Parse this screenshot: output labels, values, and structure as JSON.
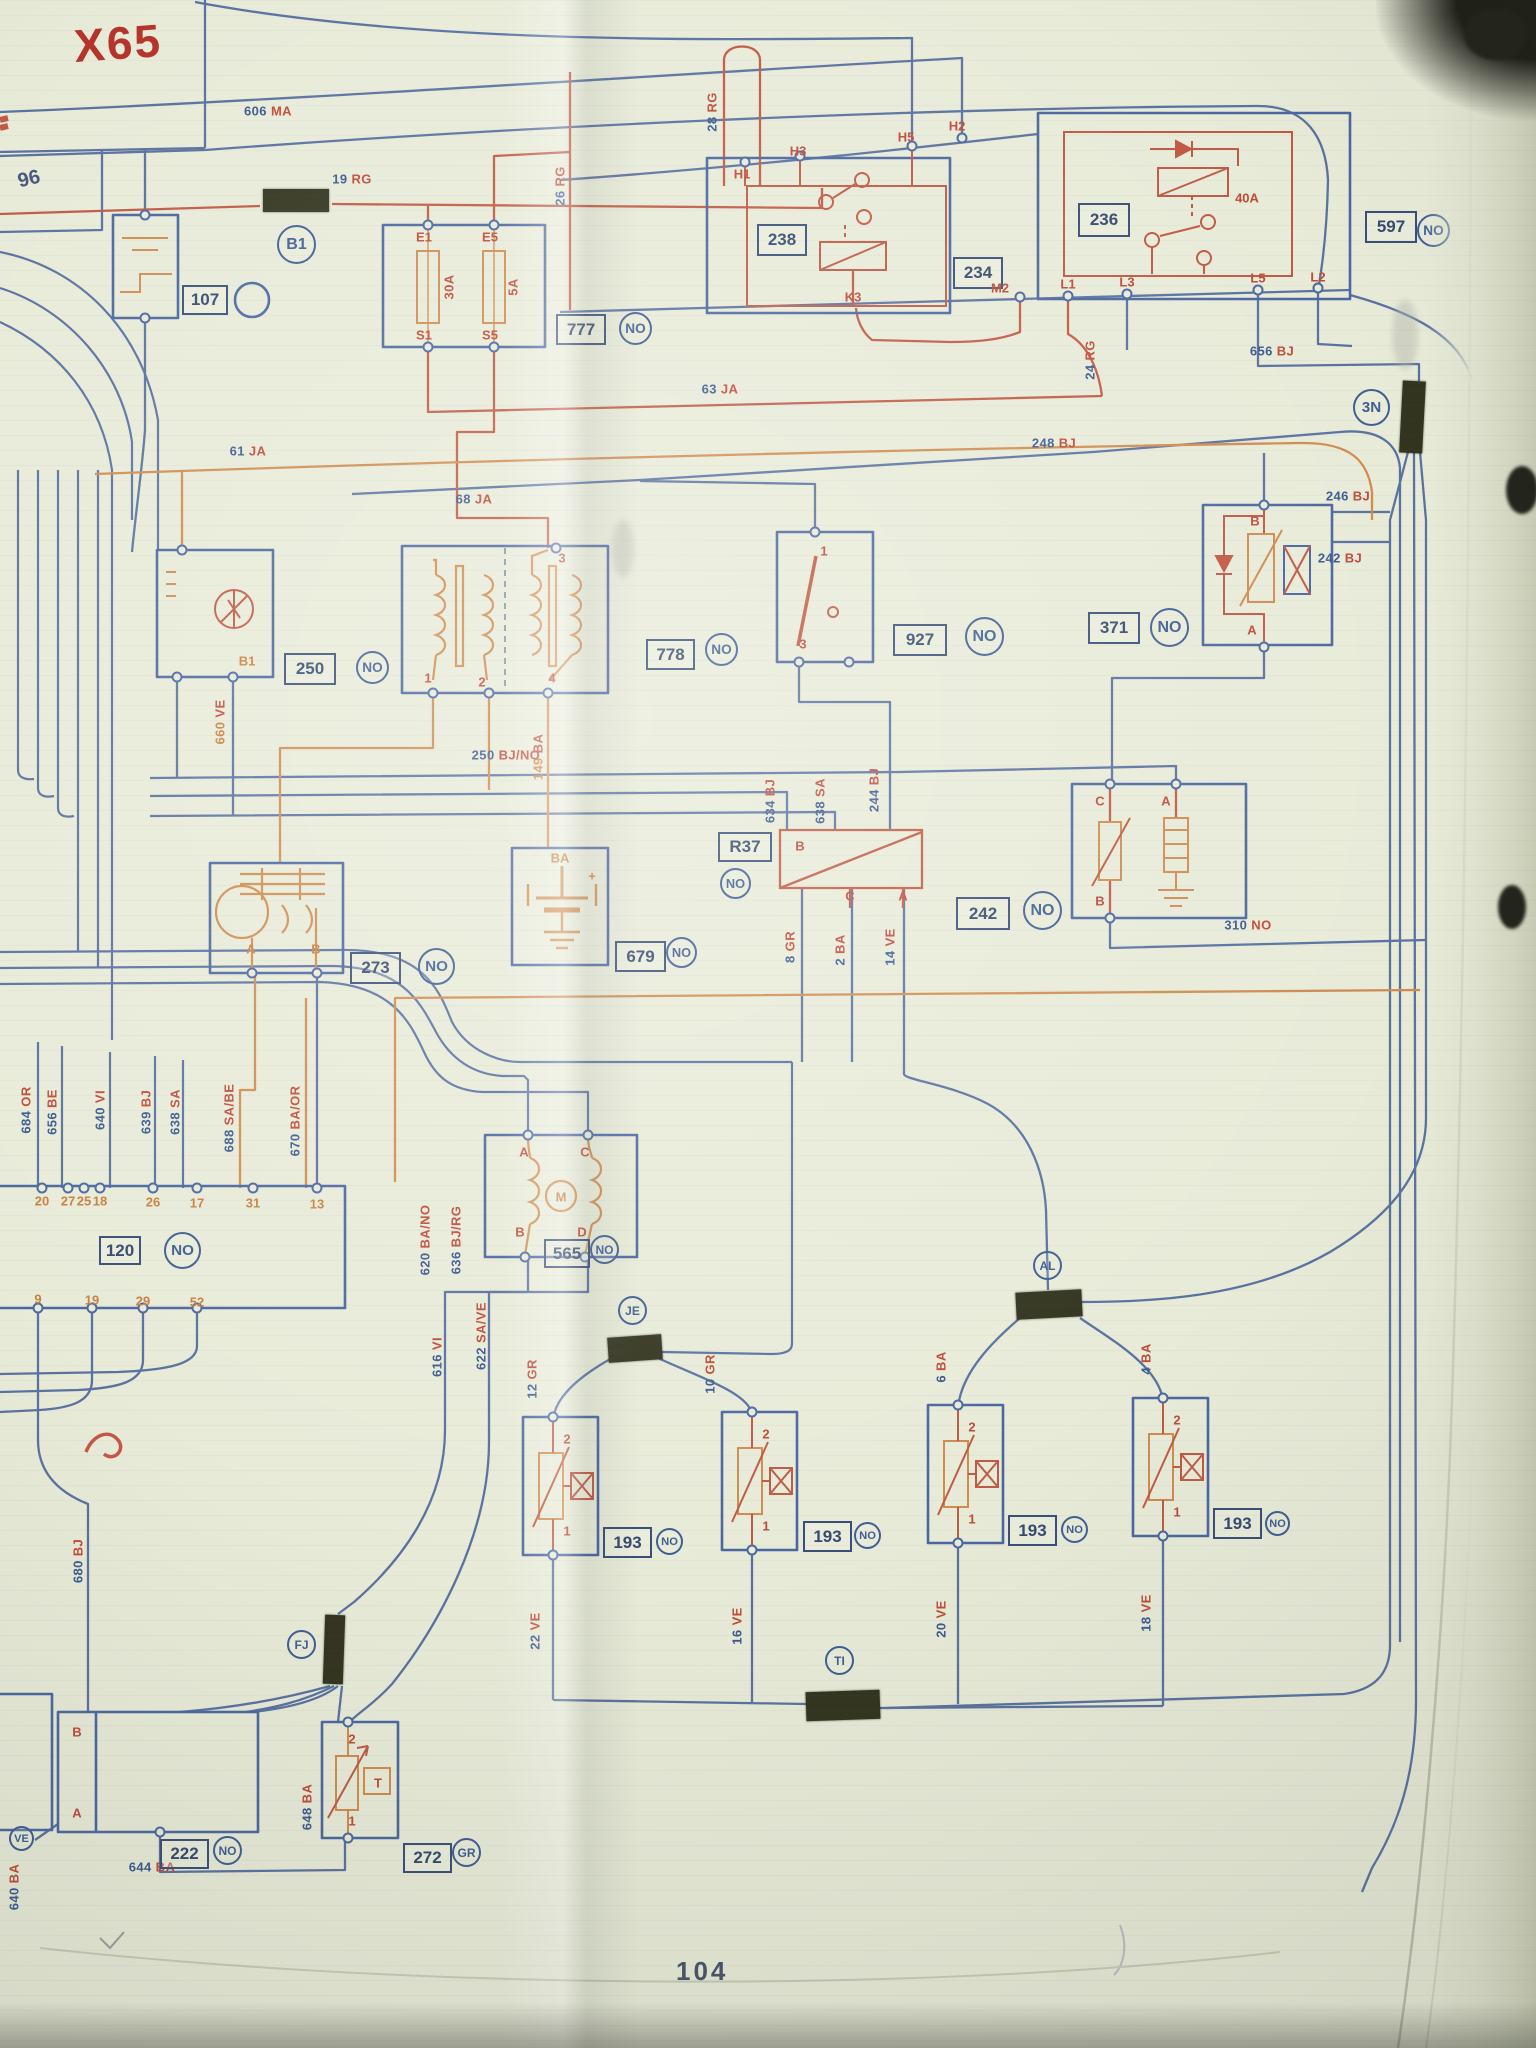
{
  "page": {
    "model_code": "X65",
    "corner_ref": "96",
    "page_number": "104"
  },
  "palette": {
    "num_blue": "#3b5a8f",
    "code_red": "#c04a38",
    "orange": "#c87f3e",
    "tag_ink": "#36496f",
    "wire_blue": "#5a72a0",
    "wire_red": "#c05a44",
    "wire_orange": "#cf8c50",
    "paper": "#e8ebd8"
  },
  "component_tags": [
    {
      "label": "238",
      "x": 757,
      "y": 224,
      "w": 46,
      "h": 28
    },
    {
      "label": "236",
      "x": 1078,
      "y": 203,
      "w": 48,
      "h": 30
    },
    {
      "label": "234",
      "x": 953,
      "y": 257,
      "w": 46,
      "h": 28
    },
    {
      "label": "777",
      "x": 556,
      "y": 314,
      "w": 46,
      "h": 27
    },
    {
      "label": "597",
      "x": 1365,
      "y": 211,
      "w": 48,
      "h": 28
    },
    {
      "label": "107",
      "x": 182,
      "y": 285,
      "w": 42,
      "h": 26
    },
    {
      "label": "250",
      "x": 284,
      "y": 653,
      "w": 48,
      "h": 28
    },
    {
      "label": "778",
      "x": 646,
      "y": 639,
      "w": 45,
      "h": 27
    },
    {
      "label": "927",
      "x": 893,
      "y": 624,
      "w": 50,
      "h": 28
    },
    {
      "label": "371",
      "x": 1088,
      "y": 612,
      "w": 48,
      "h": 28
    },
    {
      "label": "242",
      "x": 956,
      "y": 897,
      "w": 50,
      "h": 29
    },
    {
      "label": "273",
      "x": 350,
      "y": 952,
      "w": 47,
      "h": 28
    },
    {
      "label": "679",
      "x": 615,
      "y": 941,
      "w": 47,
      "h": 27
    },
    {
      "label": "565",
      "x": 544,
      "y": 1239,
      "w": 42,
      "h": 25
    },
    {
      "label": "120",
      "x": 99,
      "y": 1236,
      "w": 38,
      "h": 25
    },
    {
      "label": "R37",
      "x": 718,
      "y": 832,
      "w": 50,
      "h": 26
    },
    {
      "label": "222",
      "x": 160,
      "y": 1839,
      "w": 45,
      "h": 26
    },
    {
      "label": "272",
      "x": 403,
      "y": 1843,
      "w": 45,
      "h": 26
    },
    {
      "label": "193",
      "x": 603,
      "y": 1527,
      "w": 45,
      "h": 27
    },
    {
      "label": "193",
      "x": 803,
      "y": 1521,
      "w": 45,
      "h": 27
    },
    {
      "label": "193",
      "x": 1008,
      "y": 1515,
      "w": 45,
      "h": 27
    },
    {
      "label": "193",
      "x": 1213,
      "y": 1508,
      "w": 45,
      "h": 27
    }
  ],
  "circle_tags": [
    {
      "label": "NO",
      "x": 636,
      "y": 329,
      "r": 17
    },
    {
      "label": "NO",
      "x": 1434,
      "y": 231,
      "r": 17
    },
    {
      "label": "NO",
      "x": 373,
      "y": 668,
      "r": 17
    },
    {
      "label": "NO",
      "x": 722,
      "y": 650,
      "r": 17
    },
    {
      "label": "NO",
      "x": 985,
      "y": 637,
      "r": 20
    },
    {
      "label": "NO",
      "x": 1170,
      "y": 628,
      "r": 20
    },
    {
      "label": "NO",
      "x": 1043,
      "y": 911,
      "r": 20
    },
    {
      "label": "NO",
      "x": 437,
      "y": 967,
      "r": 19
    },
    {
      "label": "NO",
      "x": 682,
      "y": 953,
      "r": 16
    },
    {
      "label": "NO",
      "x": 605,
      "y": 1250,
      "r": 15
    },
    {
      "label": "NO",
      "x": 183,
      "y": 1251,
      "r": 19
    },
    {
      "label": "NO",
      "x": 736,
      "y": 884,
      "r": 16
    },
    {
      "label": "NO",
      "x": 670,
      "y": 1542,
      "r": 14
    },
    {
      "label": "NO",
      "x": 868,
      "y": 1536,
      "r": 14
    },
    {
      "label": "NO",
      "x": 1075,
      "y": 1530,
      "r": 14
    },
    {
      "label": "NO",
      "x": 1278,
      "y": 1524,
      "r": 13
    },
    {
      "label": "NO",
      "x": 228,
      "y": 1851,
      "r": 15
    },
    {
      "label": "GR",
      "x": 467,
      "y": 1853,
      "r": 15
    },
    {
      "label": "B1",
      "x": 297,
      "y": 245,
      "r": 20
    },
    {
      "label": "3N",
      "x": 1372,
      "y": 408,
      "r": 19
    },
    {
      "label": "JE",
      "x": 633,
      "y": 1311,
      "r": 15
    },
    {
      "label": "AL",
      "x": 1048,
      "y": 1266,
      "r": 15
    },
    {
      "label": "TI",
      "x": 840,
      "y": 1661,
      "r": 15
    },
    {
      "label": "FJ",
      "x": 302,
      "y": 1645,
      "r": 15
    },
    {
      "label": "VE",
      "x": 22,
      "y": 1839,
      "r": 13
    }
  ],
  "wire_labels": [
    {
      "text": "606 MA",
      "x": 268,
      "y": 111,
      "rot": 0
    },
    {
      "text": "19 RG",
      "x": 352,
      "y": 179,
      "rot": 0
    },
    {
      "text": "26 RG",
      "x": 560,
      "y": 186,
      "rot": -90
    },
    {
      "text": "28 RG",
      "x": 712,
      "y": 112,
      "rot": -90
    },
    {
      "text": "63 JA",
      "x": 720,
      "y": 389,
      "rot": 0
    },
    {
      "text": "24 RG",
      "x": 1090,
      "y": 360,
      "rot": -90
    },
    {
      "text": "656 BJ",
      "x": 1272,
      "y": 351,
      "rot": 0
    },
    {
      "text": "248 BJ",
      "x": 1054,
      "y": 443,
      "rot": 0
    },
    {
      "text": "61 JA",
      "x": 248,
      "y": 451,
      "rot": 0
    },
    {
      "text": "68 JA",
      "x": 474,
      "y": 499,
      "rot": 0
    },
    {
      "text": "660 VE",
      "x": 220,
      "y": 722,
      "rot": -90,
      "nc": "orange"
    },
    {
      "text": "149 BA",
      "x": 538,
      "y": 757,
      "rot": -90,
      "nc": "orange"
    },
    {
      "text": "250 BJ/NO",
      "x": 506,
      "y": 755,
      "rot": 0
    },
    {
      "text": "246 BJ",
      "x": 1348,
      "y": 496,
      "rot": 0
    },
    {
      "text": "242 BJ",
      "x": 1340,
      "y": 558,
      "rot": 0
    },
    {
      "text": "310 NO",
      "x": 1248,
      "y": 925,
      "rot": 0
    },
    {
      "text": "634 BJ",
      "x": 770,
      "y": 801,
      "rot": -90
    },
    {
      "text": "638 SA",
      "x": 820,
      "y": 801,
      "rot": -90
    },
    {
      "text": "244 BJ",
      "x": 874,
      "y": 790,
      "rot": -90
    },
    {
      "text": "8 GR",
      "x": 790,
      "y": 947,
      "rot": -90
    },
    {
      "text": "2 BA",
      "x": 840,
      "y": 950,
      "rot": -90
    },
    {
      "text": "14 VE",
      "x": 890,
      "y": 947,
      "rot": -90
    },
    {
      "text": "684 OR",
      "x": 26,
      "y": 1110,
      "rot": -90
    },
    {
      "text": "656 BE",
      "x": 52,
      "y": 1112,
      "rot": -90
    },
    {
      "text": "640 VI",
      "x": 100,
      "y": 1110,
      "rot": -90
    },
    {
      "text": "639 BJ",
      "x": 146,
      "y": 1112,
      "rot": -90
    },
    {
      "text": "638 SA",
      "x": 175,
      "y": 1112,
      "rot": -90
    },
    {
      "text": "688 SA/BE",
      "x": 229,
      "y": 1118,
      "rot": -90
    },
    {
      "text": "670 BA/OR",
      "x": 295,
      "y": 1121,
      "rot": -90
    },
    {
      "text": "620 BA/NO",
      "x": 425,
      "y": 1240,
      "rot": -90
    },
    {
      "text": "636 BJ/RG",
      "x": 456,
      "y": 1240,
      "rot": -90
    },
    {
      "text": "616 VI",
      "x": 437,
      "y": 1357,
      "rot": -90
    },
    {
      "text": "622 SA/VE",
      "x": 481,
      "y": 1336,
      "rot": -90
    },
    {
      "text": "12 GR",
      "x": 532,
      "y": 1379,
      "rot": -90
    },
    {
      "text": "10 GR",
      "x": 710,
      "y": 1374,
      "rot": -90
    },
    {
      "text": "6 BA",
      "x": 941,
      "y": 1367,
      "rot": -90
    },
    {
      "text": "4 BA",
      "x": 1146,
      "y": 1359,
      "rot": -90
    },
    {
      "text": "22 VE",
      "x": 535,
      "y": 1631,
      "rot": -90
    },
    {
      "text": "16 VE",
      "x": 737,
      "y": 1626,
      "rot": -90
    },
    {
      "text": "20 VE",
      "x": 941,
      "y": 1619,
      "rot": -90
    },
    {
      "text": "18 VE",
      "x": 1146,
      "y": 1613,
      "rot": -90
    },
    {
      "text": "644 BA",
      "x": 152,
      "y": 1867,
      "rot": 0
    },
    {
      "text": "648 BA",
      "x": 307,
      "y": 1807,
      "rot": -90
    },
    {
      "text": "680 BJ",
      "x": 78,
      "y": 1561,
      "rot": -90
    },
    {
      "text": "640 BA",
      "x": 14,
      "y": 1887,
      "rot": -90
    },
    {
      "text": "30A",
      "x": 449,
      "y": 287,
      "rot": -90
    },
    {
      "text": "5A",
      "x": 513,
      "y": 287,
      "rot": -90
    }
  ],
  "terminals": [
    {
      "t": "E1",
      "x": 424,
      "y": 237,
      "c": "red"
    },
    {
      "t": "E5",
      "x": 490,
      "y": 237,
      "c": "red"
    },
    {
      "t": "S1",
      "x": 424,
      "y": 335,
      "c": "red"
    },
    {
      "t": "S5",
      "x": 490,
      "y": 335,
      "c": "red"
    },
    {
      "t": "H1",
      "x": 742,
      "y": 174,
      "c": "red"
    },
    {
      "t": "H3",
      "x": 798,
      "y": 151,
      "c": "red"
    },
    {
      "t": "H5",
      "x": 906,
      "y": 137,
      "c": "red"
    },
    {
      "t": "H2",
      "x": 957,
      "y": 126,
      "c": "red"
    },
    {
      "t": "K3",
      "x": 853,
      "y": 297,
      "c": "red"
    },
    {
      "t": "M2",
      "x": 1000,
      "y": 288,
      "c": "red"
    },
    {
      "t": "L1",
      "x": 1068,
      "y": 284,
      "c": "red"
    },
    {
      "t": "L3",
      "x": 1127,
      "y": 282,
      "c": "red"
    },
    {
      "t": "L5",
      "x": 1258,
      "y": 278,
      "c": "red"
    },
    {
      "t": "L2",
      "x": 1318,
      "y": 277,
      "c": "red"
    },
    {
      "t": "40A",
      "x": 1247,
      "y": 198,
      "c": "red"
    },
    {
      "t": "3",
      "x": 562,
      "y": 558,
      "c": "red"
    },
    {
      "t": "1",
      "x": 428,
      "y": 678,
      "c": "red"
    },
    {
      "t": "2",
      "x": 482,
      "y": 682,
      "c": "red"
    },
    {
      "t": "4",
      "x": 552,
      "y": 678,
      "c": "red"
    },
    {
      "t": "1",
      "x": 824,
      "y": 551,
      "c": "red"
    },
    {
      "t": "3",
      "x": 803,
      "y": 644,
      "c": "red"
    },
    {
      "t": "B",
      "x": 1255,
      "y": 521,
      "c": "red"
    },
    {
      "t": "A",
      "x": 1252,
      "y": 630,
      "c": "red"
    },
    {
      "t": "C",
      "x": 1100,
      "y": 801,
      "c": "red"
    },
    {
      "t": "A",
      "x": 1166,
      "y": 801,
      "c": "red"
    },
    {
      "t": "B",
      "x": 1100,
      "y": 901,
      "c": "red"
    },
    {
      "t": "A",
      "x": 251,
      "y": 949,
      "c": "orange"
    },
    {
      "t": "B",
      "x": 316,
      "y": 949,
      "c": "orange"
    },
    {
      "t": "B1",
      "x": 247,
      "y": 661,
      "c": "orange"
    },
    {
      "t": "BA",
      "x": 560,
      "y": 858,
      "c": "orange"
    },
    {
      "t": "+",
      "x": 592,
      "y": 876,
      "c": "orange"
    },
    {
      "t": "B",
      "x": 800,
      "y": 846,
      "c": "red"
    },
    {
      "t": "C",
      "x": 850,
      "y": 896,
      "c": "red"
    },
    {
      "t": "A",
      "x": 903,
      "y": 896,
      "c": "red"
    },
    {
      "t": "A",
      "x": 524,
      "y": 1152,
      "c": "red"
    },
    {
      "t": "C",
      "x": 585,
      "y": 1152,
      "c": "red"
    },
    {
      "t": "B",
      "x": 520,
      "y": 1232,
      "c": "red"
    },
    {
      "t": "D",
      "x": 582,
      "y": 1232,
      "c": "red"
    },
    {
      "t": "M",
      "x": 561,
      "y": 1197,
      "c": "orange"
    },
    {
      "t": "2",
      "x": 567,
      "y": 1439,
      "c": "red"
    },
    {
      "t": "1",
      "x": 567,
      "y": 1531,
      "c": "red"
    },
    {
      "t": "2",
      "x": 766,
      "y": 1434,
      "c": "red"
    },
    {
      "t": "1",
      "x": 766,
      "y": 1526,
      "c": "red"
    },
    {
      "t": "2",
      "x": 972,
      "y": 1427,
      "c": "red"
    },
    {
      "t": "1",
      "x": 972,
      "y": 1519,
      "c": "red"
    },
    {
      "t": "2",
      "x": 1177,
      "y": 1420,
      "c": "red"
    },
    {
      "t": "1",
      "x": 1177,
      "y": 1512,
      "c": "red"
    },
    {
      "t": "2",
      "x": 352,
      "y": 1739,
      "c": "red"
    },
    {
      "t": "1",
      "x": 352,
      "y": 1821,
      "c": "red"
    },
    {
      "t": "T",
      "x": 378,
      "y": 1783,
      "c": "red"
    },
    {
      "t": "B",
      "x": 77,
      "y": 1732,
      "c": "red"
    },
    {
      "t": "A",
      "x": 77,
      "y": 1813,
      "c": "red"
    },
    {
      "t": "20",
      "x": 42,
      "y": 1201,
      "c": "orange"
    },
    {
      "t": "27",
      "x": 68,
      "y": 1201,
      "c": "orange"
    },
    {
      "t": "25",
      "x": 84,
      "y": 1201,
      "c": "orange"
    },
    {
      "t": "18",
      "x": 100,
      "y": 1201,
      "c": "orange"
    },
    {
      "t": "26",
      "x": 153,
      "y": 1202,
      "c": "orange"
    },
    {
      "t": "17",
      "x": 197,
      "y": 1203,
      "c": "orange"
    },
    {
      "t": "31",
      "x": 253,
      "y": 1203,
      "c": "orange"
    },
    {
      "t": "13",
      "x": 317,
      "y": 1204,
      "c": "orange"
    },
    {
      "t": "9",
      "x": 38,
      "y": 1299,
      "c": "orange"
    },
    {
      "t": "19",
      "x": 92,
      "y": 1300,
      "c": "orange"
    },
    {
      "t": "29",
      "x": 143,
      "y": 1301,
      "c": "orange"
    },
    {
      "t": "52",
      "x": 197,
      "y": 1302,
      "c": "orange"
    }
  ],
  "connectors": [
    {
      "x": 263,
      "y": 189,
      "w": 66,
      "h": 23,
      "a": 0
    },
    {
      "x": 1401,
      "y": 381,
      "w": 23,
      "h": 72,
      "a": 3
    },
    {
      "x": 608,
      "y": 1336,
      "w": 54,
      "h": 25,
      "a": -4
    },
    {
      "x": 1016,
      "y": 1291,
      "w": 66,
      "h": 27,
      "a": -3
    },
    {
      "x": 806,
      "y": 1691,
      "w": 74,
      "h": 29,
      "a": -2
    },
    {
      "x": 324,
      "y": 1615,
      "w": 20,
      "h": 69,
      "a": 2
    }
  ]
}
